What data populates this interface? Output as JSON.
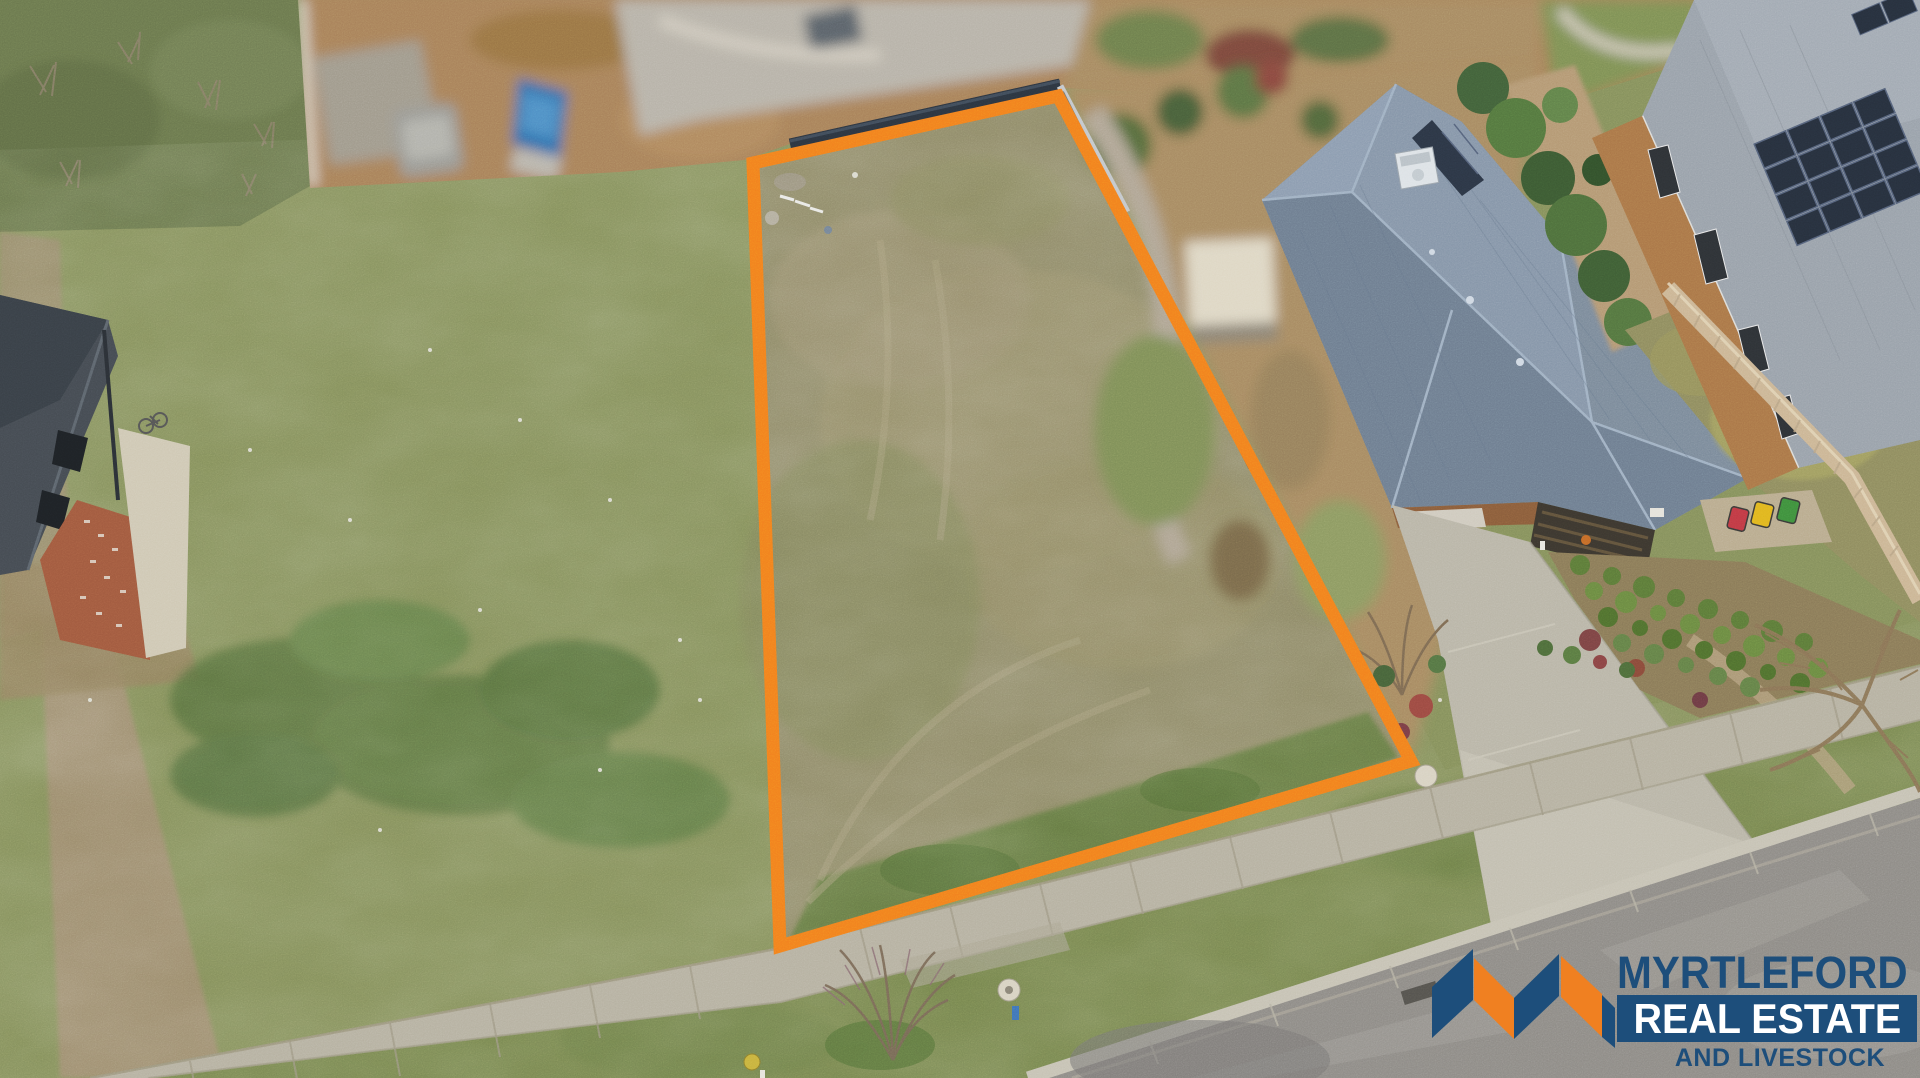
{
  "watermark": {
    "line1": "MYRTLEFORD",
    "line2": "REAL ESTATE",
    "line3": "AND LIVESTOCK"
  },
  "colors": {
    "brand-navy": "#1d4e7b",
    "brand-orange": "#f08021",
    "lot-outline": "#f2801e",
    "field-grass": "#85905c",
    "lot-grass": "#8f8a68",
    "road-asphalt": "#8e8b86",
    "concrete": "#b6b1a1",
    "roof-slate": "#7b8a9a",
    "roof-light": "#99a1aa",
    "brick": "#aa7648",
    "fence-dark": "#2c3540",
    "fence-tan": "#cbb594",
    "hedge-green": "#4e6f3c",
    "dirt": "#a8815a",
    "boat-blue": "#2f6fad"
  },
  "scene": {
    "elements": [
      "vacant-land-lot",
      "orange-lot-boundary",
      "grass-field",
      "timber-fence",
      "blurred-neighbour-backyard",
      "hip-roof-house",
      "rooftop-air-conditioner",
      "solar-panel-array",
      "brick-house",
      "garden-shrub-rows",
      "wheelie-bins",
      "driveway",
      "concrete-footpath",
      "nature-strip",
      "street-road",
      "kerb",
      "dead-tree",
      "leafless-shrub",
      "dark-roof-house",
      "brick-paving",
      "boat-on-trailer",
      "blurred-dirt-yard",
      "blurred-street"
    ]
  }
}
